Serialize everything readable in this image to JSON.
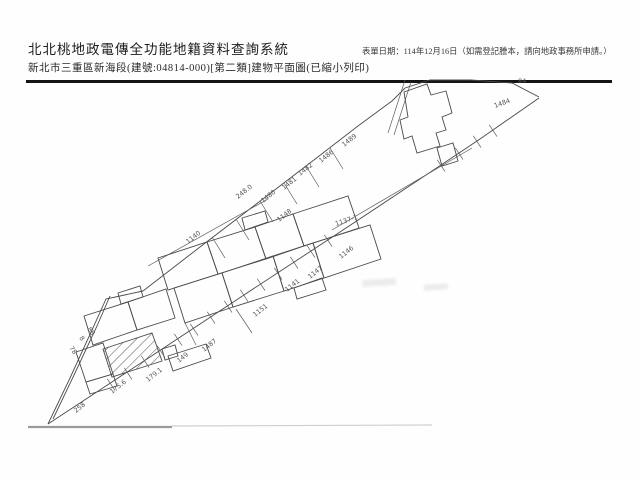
{
  "header": {
    "system_title": "北北桃地政電傳全功能地籍資料查詢系統",
    "location_line": "新北市三重區新海段(建號:04814-000)[第二類]建物平面圖(已縮小列印)",
    "date_note": "表單日期：114年12月16日（如需登記謄本，請向地政事務所申請。）"
  },
  "map": {
    "ink_color": "#4a4a4a",
    "label_color": "#555555",
    "labels": [
      {
        "t": "1489",
        "x": 344,
        "y": 147,
        "r": -38
      },
      {
        "t": "1486",
        "x": 321,
        "y": 163,
        "r": -38
      },
      {
        "t": "1482",
        "x": 300,
        "y": 176,
        "r": -38
      },
      {
        "t": "1481",
        "x": 284,
        "y": 190,
        "r": -38
      },
      {
        "t": "1480",
        "x": 263,
        "y": 203,
        "r": -38
      },
      {
        "t": "248.0",
        "x": 238,
        "y": 199,
        "r": -38
      },
      {
        "t": "1484",
        "x": 495,
        "y": 108,
        "r": -20
      },
      {
        "t": "84",
        "x": 518,
        "y": 83,
        "r": 0
      },
      {
        "t": "1140",
        "x": 188,
        "y": 244,
        "r": -38
      },
      {
        "t": "1148",
        "x": 279,
        "y": 222,
        "r": -38
      },
      {
        "t": "1137-1",
        "x": 336,
        "y": 226,
        "r": -18
      },
      {
        "t": "1146",
        "x": 341,
        "y": 259,
        "r": -38
      },
      {
        "t": "1147",
        "x": 310,
        "y": 279,
        "r": -38
      },
      {
        "t": "1141",
        "x": 287,
        "y": 292,
        "r": -38
      },
      {
        "t": "1151",
        "x": 255,
        "y": 317,
        "r": -38
      },
      {
        "t": "1487",
        "x": 204,
        "y": 352,
        "r": -38
      },
      {
        "t": "149",
        "x": 179,
        "y": 363,
        "r": -38
      },
      {
        "t": "179.1",
        "x": 148,
        "y": 382,
        "r": -38
      },
      {
        "t": "175.6",
        "x": 112,
        "y": 394,
        "r": -38
      },
      {
        "t": "258",
        "x": 76,
        "y": 413,
        "r": -38
      },
      {
        "t": "78",
        "x": 69,
        "y": 348,
        "r": 55
      },
      {
        "t": "8",
        "x": 79,
        "y": 338,
        "r": 55
      },
      {
        "t": "88",
        "x": 87,
        "y": 329,
        "r": 55
      }
    ],
    "ticks": [
      [
        110,
        383
      ],
      [
        127,
        372
      ],
      [
        144,
        360
      ],
      [
        160,
        350
      ],
      [
        177,
        338
      ],
      [
        193,
        328
      ],
      [
        210,
        316
      ],
      [
        227,
        305
      ],
      [
        243,
        294
      ],
      [
        260,
        283
      ],
      [
        277,
        272
      ],
      [
        293,
        261
      ],
      [
        310,
        250
      ],
      [
        327,
        239
      ],
      [
        440,
        164
      ],
      [
        458,
        152
      ],
      [
        476,
        140
      ],
      [
        492,
        129
      ]
    ],
    "division_lines": [
      [
        212,
        237,
        225,
        258
      ],
      [
        236,
        219,
        249,
        240
      ],
      [
        260,
        201,
        273,
        222
      ],
      [
        284,
        183,
        297,
        204
      ],
      [
        306,
        166,
        319,
        187
      ],
      [
        330,
        148,
        343,
        169
      ]
    ]
  }
}
